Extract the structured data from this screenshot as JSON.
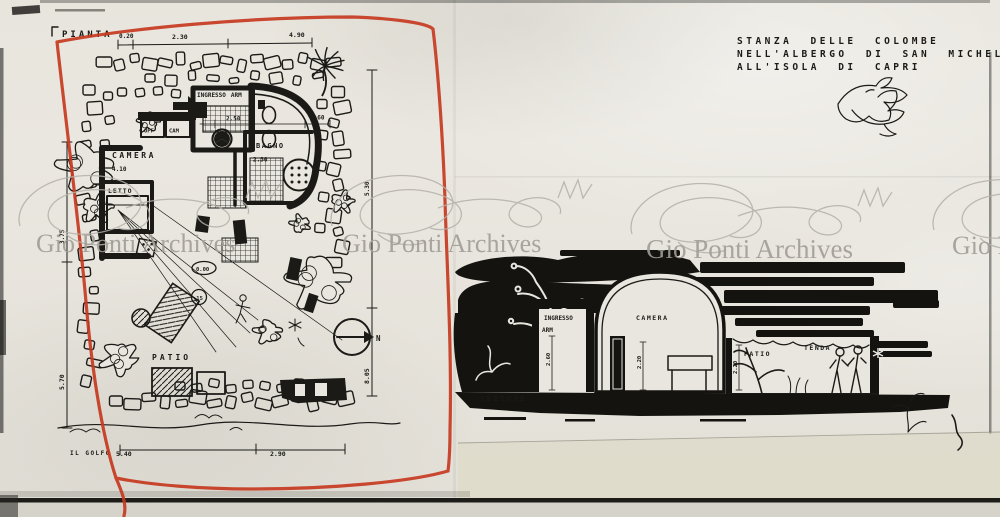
{
  "title_block": {
    "lines": [
      "STANZA DELLE COLOMBE",
      "NELL'ALBERGO DI SAN MICHELE",
      "ALL'ISOLA DI CAPRI"
    ]
  },
  "watermark": {
    "text": "Gio Ponti Archives"
  },
  "plan": {
    "label": "PIANTA",
    "rooms": {
      "ingresso": "INGRESSO",
      "arm": "ARM",
      "off": "OFF",
      "cam": "CAM",
      "camera": "CAMERA",
      "bagno": "BAGNO",
      "letto": "LETTO",
      "patio": "PATIO"
    },
    "levels": {
      "zero": "0.00",
      "minus": "·15"
    },
    "dims": {
      "top": [
        "0.20",
        "2.30",
        "4.90"
      ],
      "ingresso_w": "2.50",
      "corridor": "1.60",
      "bagno_w": "2.30",
      "camera_w": "4.10",
      "right_upper": "5.30",
      "right_lower": "8.05",
      "left_upper": "3.75",
      "left_lower": "5.70",
      "bottom_left": "5.40",
      "bottom_right": "2.90"
    },
    "coast_label": "IL GOLFO",
    "north_label": "N"
  },
  "section": {
    "label": "SEZIONE",
    "rooms": {
      "ingresso": "INGRESSO",
      "arm": "ARM",
      "camera": "CAMERA",
      "patio": "PATIO",
      "tenda": "TENDA"
    },
    "dims": {
      "arm_h": "2.60",
      "camera_h": "2.20",
      "patio_h": "2.20"
    }
  },
  "colors": {
    "red_outline": "#c6391f",
    "ink": "#1b1a17",
    "paper": "#e9e6df",
    "watermark": "#a19d96"
  }
}
